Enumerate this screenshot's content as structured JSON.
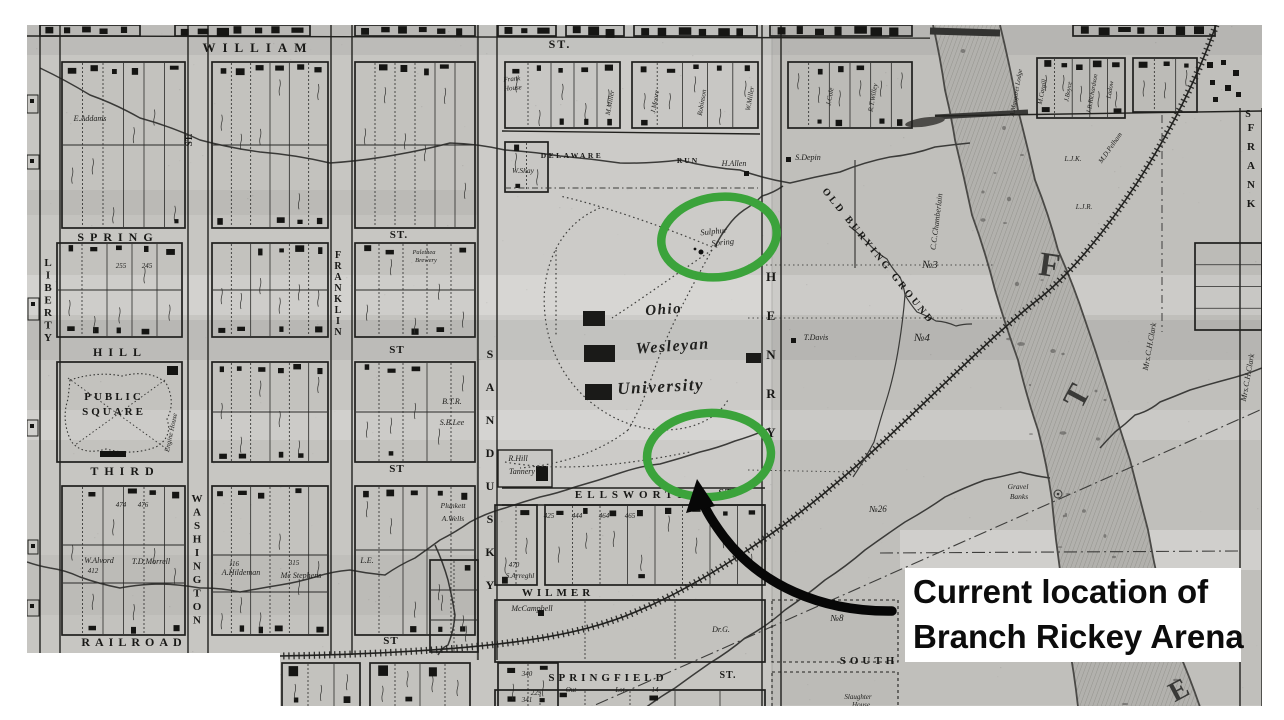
{
  "annotation": {
    "line1": "Current location of",
    "line2": "Branch Rickey Arena",
    "highlight_color": "#3ba33b",
    "arrow_color": "#070707",
    "label_bg": "#ffffff",
    "label_fg": "#0c0c0c",
    "ellipses": [
      {
        "cx": 719,
        "cy": 237,
        "rx": 58,
        "ry": 40,
        "rot": -8
      },
      {
        "cx": 709,
        "cy": 455,
        "rx": 62,
        "ry": 42,
        "rot": -3
      }
    ],
    "arrow": {
      "tail_x": 892,
      "tail_y": 611,
      "tip_x": 697,
      "tip_y": 481
    }
  },
  "map": {
    "colors": {
      "paper": "#c7c6c2",
      "ink": "#1c1c1a",
      "river": "#b2b1ad"
    },
    "street_labels_h": [
      {
        "t": "WILLIAM",
        "x": 258,
        "y": 52,
        "s": 13,
        "sp": 7
      },
      {
        "t": "ST.",
        "x": 560,
        "y": 48,
        "s": 12,
        "sp": 2
      },
      {
        "t": "SPRING",
        "x": 118,
        "y": 241,
        "s": 12,
        "sp": 6
      },
      {
        "t": "ST.",
        "x": 399,
        "y": 238,
        "s": 11,
        "sp": 1
      },
      {
        "t": "HILL",
        "x": 120,
        "y": 356,
        "s": 12,
        "sp": 6
      },
      {
        "t": "ST",
        "x": 397,
        "y": 353,
        "s": 11,
        "sp": 1
      },
      {
        "t": "THIRD",
        "x": 125,
        "y": 475,
        "s": 12,
        "sp": 6
      },
      {
        "t": "ST",
        "x": 397,
        "y": 472,
        "s": 11,
        "sp": 1
      },
      {
        "t": "RAILROAD",
        "x": 134,
        "y": 646,
        "s": 12,
        "sp": 5
      },
      {
        "t": "ST",
        "x": 391,
        "y": 644,
        "s": 11,
        "sp": 1
      },
      {
        "t": "ELLSWORTH",
        "x": 633,
        "y": 498,
        "s": 11,
        "sp": 5
      },
      {
        "t": "ST.",
        "x": 727,
        "y": 496,
        "s": 10,
        "sp": 1
      },
      {
        "t": "WILMER",
        "x": 558,
        "y": 596,
        "s": 11,
        "sp": 4
      },
      {
        "t": "SPRINGFIELD",
        "x": 608,
        "y": 681,
        "s": 11,
        "sp": 4
      },
      {
        "t": "ST.",
        "x": 728,
        "y": 678,
        "s": 10,
        "sp": 1
      },
      {
        "t": "SOUTH",
        "x": 869,
        "y": 664,
        "s": 11,
        "sp": 4
      },
      {
        "t": "DELAWARE",
        "x": 572,
        "y": 158,
        "s": 7.5,
        "sp": 2.5
      },
      {
        "t": "RUN",
        "x": 688,
        "y": 163,
        "s": 7.5,
        "sp": 2
      }
    ],
    "street_labels_v": [
      {
        "t": "LIBERTY",
        "x": 48,
        "y": 266,
        "dy": 12.5,
        "s": 11
      },
      {
        "t": "WASHINGTON",
        "x": 197,
        "y": 502,
        "dy": 13.5,
        "s": 11
      },
      {
        "t": "FRANKLIN",
        "x": 338,
        "y": 258,
        "dy": 11,
        "s": 10
      },
      {
        "t": "SANDUSKY",
        "x": 490,
        "y": 358,
        "dy": 33,
        "s": 12
      },
      {
        "t": "HENRY",
        "x": 771,
        "y": 281,
        "dy": 39,
        "s": 13
      },
      {
        "t": "FRANK",
        "x": 1251,
        "y": 131,
        "dy": 19,
        "s": 11
      }
    ],
    "place_labels": [
      {
        "t": "Sulphur",
        "x": 714,
        "y": 234,
        "s": 8.5,
        "r": -6,
        "st": "i"
      },
      {
        "t": "Spring",
        "x": 723,
        "y": 245,
        "s": 8.5,
        "r": -6,
        "st": "i"
      },
      {
        "t": "Ohio",
        "x": 664,
        "y": 314,
        "s": 15,
        "r": -4,
        "st": "sc"
      },
      {
        "t": "Wesleyan",
        "x": 673,
        "y": 351,
        "s": 16,
        "r": -4,
        "st": "sc"
      },
      {
        "t": "University",
        "x": 661,
        "y": 392,
        "s": 17,
        "r": -3,
        "st": "sc"
      },
      {
        "t": "PUBLIC",
        "x": 114,
        "y": 400,
        "s": 11,
        "sp": 3,
        "st": "caps"
      },
      {
        "t": "SQUARE",
        "x": 114,
        "y": 415,
        "s": 11,
        "sp": 3,
        "st": "caps"
      },
      {
        "t": "H.Allen",
        "x": 734,
        "y": 166,
        "s": 8,
        "st": "i"
      },
      {
        "t": "S.Depin",
        "x": 808,
        "y": 160,
        "s": 8,
        "st": "i"
      },
      {
        "t": "T.Davis",
        "x": 816,
        "y": 340,
        "s": 8,
        "st": "i"
      },
      {
        "t": "C.C.Chamberlain",
        "x": 939,
        "y": 222,
        "s": 8,
        "r": -83,
        "st": "i"
      },
      {
        "t": "OLD BURYING GROUND",
        "x": 876,
        "y": 258,
        "s": 10,
        "r": 51,
        "sp": 3,
        "st": "caps"
      },
      {
        "t": "№3",
        "x": 930,
        "y": 268,
        "s": 11,
        "st": "i"
      },
      {
        "t": "№4",
        "x": 922,
        "y": 341,
        "s": 11,
        "st": "i"
      },
      {
        "t": "№26",
        "x": 878,
        "y": 512,
        "s": 9,
        "st": "i"
      },
      {
        "t": "№8",
        "x": 837,
        "y": 621,
        "s": 9,
        "st": "i"
      },
      {
        "t": "Gravel",
        "x": 1018,
        "y": 489,
        "s": 7.5,
        "st": "i"
      },
      {
        "t": "Banks",
        "x": 1019,
        "y": 499,
        "s": 7.5,
        "st": "i"
      },
      {
        "t": "Mrs.C.H.Clark",
        "x": 1152,
        "y": 347,
        "s": 8,
        "r": -80,
        "st": "i"
      },
      {
        "t": "Mrs.C.H.Clark",
        "x": 1250,
        "y": 378,
        "s": 8,
        "r": -80,
        "st": "i"
      },
      {
        "t": "McCampbell",
        "x": 532,
        "y": 611,
        "s": 8,
        "st": "i"
      },
      {
        "t": "Dr.G.",
        "x": 721,
        "y": 632,
        "s": 8,
        "st": "i"
      },
      {
        "t": "W.Alvord",
        "x": 99,
        "y": 563,
        "s": 8,
        "st": "i"
      },
      {
        "t": "412",
        "x": 93,
        "y": 573,
        "s": 7,
        "st": "i"
      },
      {
        "t": "T.D.Morrell",
        "x": 151,
        "y": 564,
        "s": 8,
        "st": "i"
      },
      {
        "t": "A.Hildeman",
        "x": 241,
        "y": 575,
        "s": 8,
        "st": "i"
      },
      {
        "t": "116",
        "x": 234,
        "y": 566,
        "s": 7,
        "st": "i"
      },
      {
        "t": "315",
        "x": 294,
        "y": 565,
        "s": 7,
        "st": "i"
      },
      {
        "t": "Mc Stephens",
        "x": 301,
        "y": 578,
        "s": 8,
        "st": "i"
      },
      {
        "t": "R.Hill",
        "x": 518,
        "y": 461,
        "s": 8,
        "st": "i"
      },
      {
        "t": "Tannery",
        "x": 522,
        "y": 474,
        "s": 8,
        "st": "i"
      },
      {
        "t": "B.T.R.",
        "x": 452,
        "y": 404,
        "s": 8,
        "st": "i"
      },
      {
        "t": "S.B.Lee",
        "x": 452,
        "y": 425,
        "s": 8,
        "st": "i"
      },
      {
        "t": "Plunkett",
        "x": 453,
        "y": 508,
        "s": 7.5,
        "st": "i"
      },
      {
        "t": "A.Wells",
        "x": 453,
        "y": 521,
        "s": 7.5,
        "st": "i"
      },
      {
        "t": "L.E.",
        "x": 367,
        "y": 563,
        "s": 8,
        "st": "i"
      },
      {
        "t": "E.Addams",
        "x": 90,
        "y": 121,
        "s": 8,
        "st": "i"
      },
      {
        "t": "Frank",
        "x": 512,
        "y": 81,
        "s": 7,
        "r": -5,
        "st": "i"
      },
      {
        "t": "House",
        "x": 513,
        "y": 90,
        "s": 7,
        "r": -5,
        "st": "i"
      },
      {
        "t": "W.Shay",
        "x": 523,
        "y": 173,
        "s": 7.5,
        "st": "i"
      },
      {
        "t": "M.Miller",
        "x": 612,
        "y": 103,
        "s": 7,
        "r": -80,
        "st": "i"
      },
      {
        "t": "J.Moore",
        "x": 657,
        "y": 102,
        "s": 7,
        "r": -80,
        "st": "i"
      },
      {
        "t": "Robinson",
        "x": 704,
        "y": 103,
        "s": 7,
        "r": -80,
        "st": "i"
      },
      {
        "t": "W.Miller",
        "x": 752,
        "y": 99,
        "s": 7,
        "r": -80,
        "st": "i"
      },
      {
        "t": "J.Cole",
        "x": 832,
        "y": 97,
        "s": 7,
        "r": -80,
        "st": "i"
      },
      {
        "t": "R.T.Willey",
        "x": 875,
        "y": 98,
        "s": 7,
        "r": -80,
        "st": "i"
      },
      {
        "t": "A.Margaret Lodge",
        "x": 1018,
        "y": 93,
        "s": 6.5,
        "r": -80,
        "st": "i"
      },
      {
        "t": "M.Cargill",
        "x": 1044,
        "y": 92,
        "s": 6.5,
        "r": -80,
        "st": "i"
      },
      {
        "t": "J.Boyce",
        "x": 1070,
        "y": 92,
        "s": 6.5,
        "r": -80,
        "st": "i"
      },
      {
        "t": "J.B.Richardson",
        "x": 1094,
        "y": 94,
        "s": 6.5,
        "r": -80,
        "st": "i"
      },
      {
        "t": "Ladow",
        "x": 1112,
        "y": 90,
        "s": 6.5,
        "r": -80,
        "st": "i"
      },
      {
        "t": "M.D.Pelham",
        "x": 1112,
        "y": 149,
        "s": 7,
        "r": -55,
        "st": "i"
      },
      {
        "t": "L.J.K.",
        "x": 1073,
        "y": 161,
        "s": 7,
        "st": "i"
      },
      {
        "t": "L.J.R.",
        "x": 1084,
        "y": 209,
        "s": 7,
        "st": "i"
      },
      {
        "t": "Engine House",
        "x": 173,
        "y": 433,
        "s": 7,
        "r": -78,
        "st": "i"
      },
      {
        "t": "Slaughter",
        "x": 858,
        "y": 699,
        "s": 7,
        "st": "i"
      },
      {
        "t": "House",
        "x": 861,
        "y": 707,
        "s": 7,
        "st": "i"
      },
      {
        "t": "Palethea",
        "x": 424,
        "y": 254,
        "s": 6.5,
        "st": "i"
      },
      {
        "t": "Brewery",
        "x": 426,
        "y": 262,
        "s": 6.5,
        "st": "i"
      },
      {
        "t": "470",
        "x": 514,
        "y": 567,
        "s": 7,
        "st": "i"
      },
      {
        "t": "S.Arreghl",
        "x": 520,
        "y": 578,
        "s": 7.5,
        "st": "i"
      },
      {
        "t": "425",
        "x": 549,
        "y": 518,
        "s": 7,
        "st": "i"
      },
      {
        "t": "444",
        "x": 577,
        "y": 518,
        "s": 7,
        "st": "i"
      },
      {
        "t": "464",
        "x": 604,
        "y": 518,
        "s": 7,
        "st": "i"
      },
      {
        "t": "465",
        "x": 630,
        "y": 518,
        "s": 7,
        "st": "i"
      },
      {
        "t": "225",
        "x": 536,
        "y": 695,
        "s": 7,
        "st": "i"
      },
      {
        "t": "Out",
        "x": 571,
        "y": 692,
        "s": 7,
        "st": "i"
      },
      {
        "t": "Lot",
        "x": 620,
        "y": 692,
        "s": 7,
        "st": "i"
      },
      {
        "t": "14",
        "x": 655,
        "y": 692,
        "s": 7,
        "st": "i"
      },
      {
        "t": "340",
        "x": 527,
        "y": 676,
        "s": 7,
        "st": "i"
      },
      {
        "t": "341",
        "x": 527,
        "y": 702,
        "s": 7,
        "st": "i"
      },
      {
        "t": "255",
        "x": 121,
        "y": 268,
        "s": 7,
        "st": "i"
      },
      {
        "t": "245",
        "x": 147,
        "y": 268,
        "s": 7,
        "st": "i"
      },
      {
        "t": "474",
        "x": 121,
        "y": 507,
        "s": 7,
        "st": "i"
      },
      {
        "t": "476",
        "x": 143,
        "y": 507,
        "s": 7,
        "st": "i"
      },
      {
        "t": "ST.",
        "x": 192,
        "y": 140,
        "s": 9,
        "r": -90,
        "st": "caps"
      },
      {
        "t": "S",
        "x": 1248,
        "y": 117,
        "s": 10,
        "st": "caps"
      }
    ],
    "big_letters": [
      {
        "t": "F",
        "x": 1048,
        "y": 276,
        "s": 34,
        "r": 8
      },
      {
        "t": "T",
        "x": 1086,
        "y": 401,
        "s": 32,
        "r": -62
      },
      {
        "t": "E",
        "x": 1183,
        "y": 698,
        "s": 28,
        "r": -28
      }
    ]
  }
}
